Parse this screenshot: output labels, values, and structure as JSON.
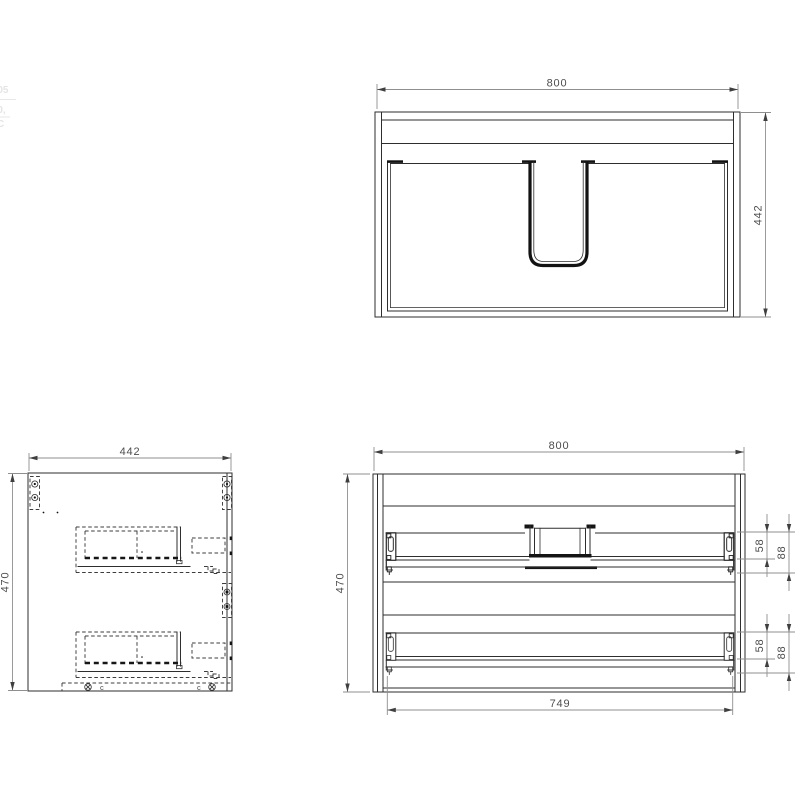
{
  "drawing": {
    "type": "furniture-technical-drawing",
    "views": {
      "top": {
        "name": "plan-view-with-basin-cutout",
        "dim_width": "800",
        "dim_depth": "442"
      },
      "side": {
        "name": "side-section-view",
        "dim_depth": "442",
        "dim_height": "470",
        "bottom_marker_left": "c",
        "bottom_marker_right": "c"
      },
      "front": {
        "name": "front-elevation-view",
        "dim_width": "800",
        "dim_height": "470",
        "dim_runner_length": "749",
        "drawer1": {
          "dim_offset_a": "58",
          "dim_offset_b": "88"
        },
        "drawer2": {
          "dim_offset_a": "58",
          "dim_offset_b": "88"
        }
      }
    },
    "edge_artifacts": {
      "line1": "-05",
      "line2": "-0,",
      "line3": "C"
    },
    "colors": {
      "background": "#ffffff",
      "body_line": "#2e2e2e",
      "hidden_line": "#3c3c3c",
      "dimension_line": "#8f8f8f",
      "dimension_text": "#4d4d4d"
    }
  }
}
